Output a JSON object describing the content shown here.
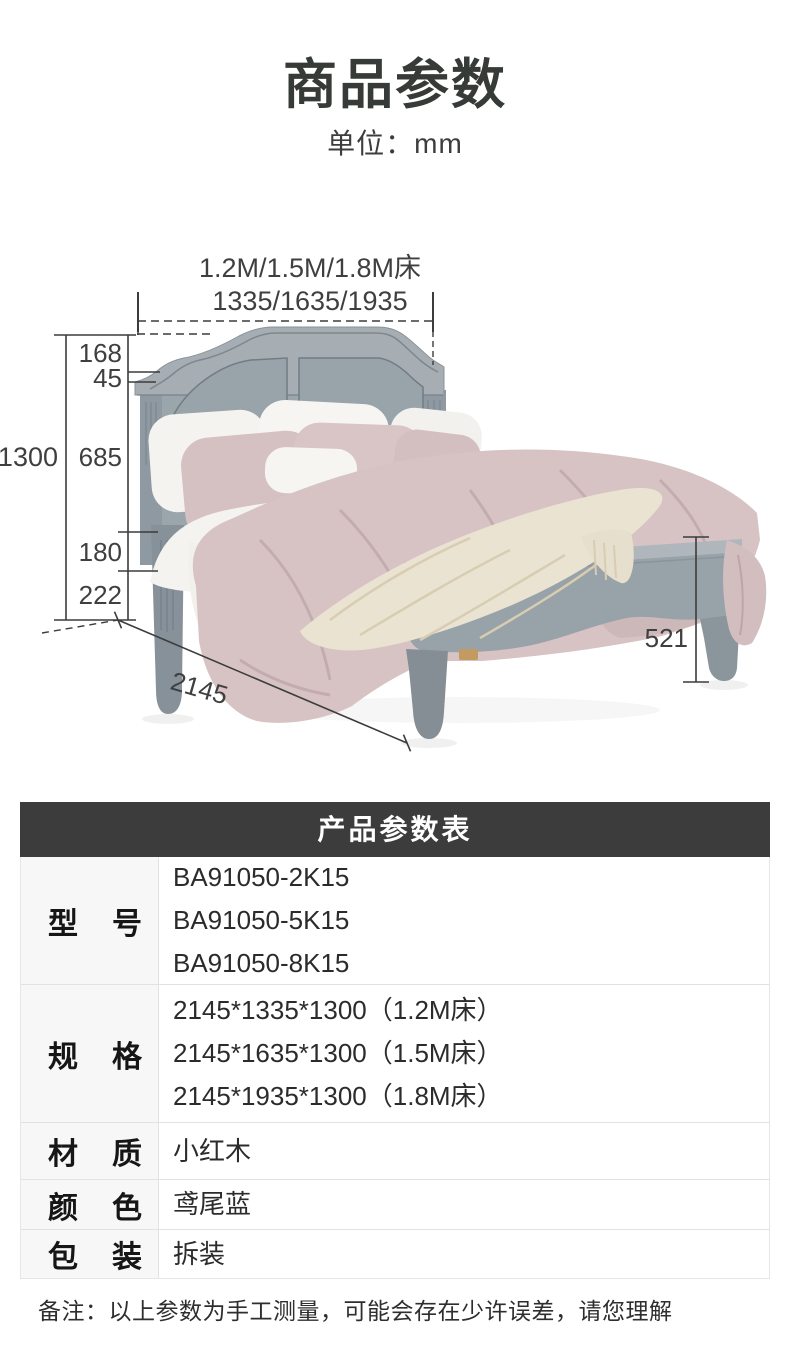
{
  "page": {
    "title": "商品参数",
    "unit": "单位：mm"
  },
  "diagram": {
    "top_label_line1": "1.2M/1.5M/1.8M床",
    "top_label_line2": "1335/1635/1935",
    "dims": {
      "total": "1300",
      "seg168": "168",
      "seg45": "45",
      "seg685": "685",
      "seg180": "180",
      "seg222": "222",
      "length": "2145",
      "foot": "521"
    }
  },
  "table": {
    "header": "产品参数表",
    "rows": [
      {
        "label_chars": [
          "型",
          "号"
        ],
        "values": [
          "BA91050-2K15",
          "BA91050-5K15",
          "BA91050-8K15"
        ]
      },
      {
        "label_chars": [
          "规",
          "格"
        ],
        "values": [
          "2145*1335*1300（1.2M床）",
          "2145*1635*1300（1.5M床）",
          "2145*1935*1300（1.8M床）"
        ]
      },
      {
        "label_chars": [
          "材",
          "质"
        ],
        "values": [
          "小红木"
        ]
      },
      {
        "label_chars": [
          "颜",
          "色"
        ],
        "values": [
          "鸢尾蓝"
        ]
      },
      {
        "label_chars": [
          "包",
          "装"
        ],
        "values": [
          "拆装"
        ]
      }
    ]
  },
  "note": "备注：以上参数为手工测量，可能会存在少许误差，请您理解",
  "colors": {
    "header_bg": "#3c3c3c",
    "header_text": "#ffffff",
    "label_bg": "#f7f7f7",
    "border": "#e2e2e2",
    "dim_line": "#3c3c3c",
    "frame_gray": "#9ba5ac",
    "frame_light": "#afb7bc",
    "frame_dark": "#7e878e",
    "bedding_pink": "#d7c3c4",
    "bedding_white": "#f4f3f0",
    "throw_cream": "#ebe3d2",
    "wood_tan": "#c39a5f"
  }
}
